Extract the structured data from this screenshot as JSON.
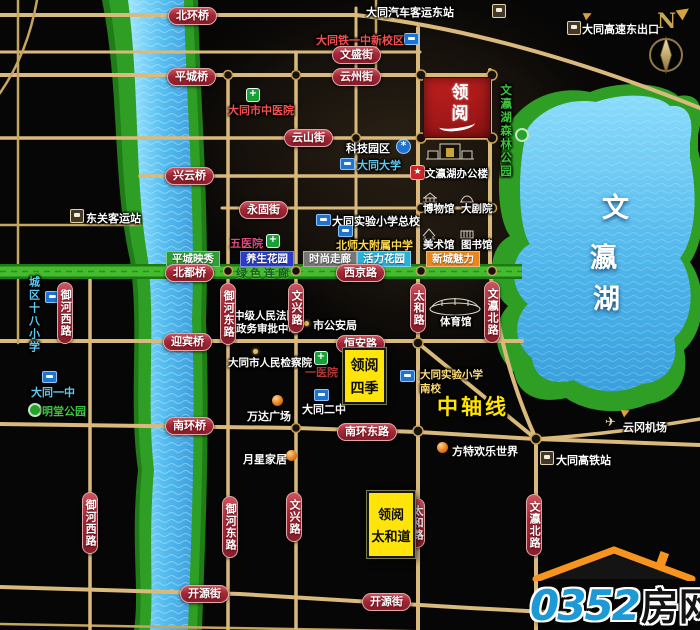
{
  "meta": {
    "compass": "N"
  },
  "project": {
    "logo_name": "领阅",
    "siji_line1": "领阅",
    "siji_line2": "四季",
    "taihedao_line1": "领阅",
    "taihedao_line2": "太和道"
  },
  "roads": {
    "beihuanqiao": "北环桥",
    "pingchengqiao": "平城桥",
    "wenshengjie": "文盛街",
    "yunzhoujie": "云州街",
    "yunshanjie": "云山街",
    "xingyunqiao": "兴云桥",
    "yonggujie": "永固街",
    "beiduqiao": "北都桥",
    "xijinglu": "西京路",
    "yingbinqiao": "迎宾桥",
    "henganlu": "恒安路",
    "nanhuanqiao": "南环桥",
    "nanhuandonglu": "南环东路",
    "kaiyuanjie": "开源街",
    "yuhexilu": "御河西路",
    "yuhedonglu": "御河东路",
    "wenxinglu": "文兴路",
    "taihelu": "太和路",
    "wenyingbeilu": "文瀛北路",
    "zhongzhouxian": "中轴线"
  },
  "zones": {
    "pingcheng_yingxiu": "平城映秀",
    "yangsheng_huayuan": "养生花园",
    "shishang_zoulan": "时尚走廊",
    "huoli_huayuan": "活力花园",
    "xincheng_meili": "新城魅力",
    "lvse_lianlang": "绿色连廊"
  },
  "places": {
    "qiche_keyun_dongzhan": "大同汽车客运东站",
    "gaosu_dongchukou": "大同高速东出口",
    "tieyizhong": "大同铁一中新校区",
    "zhongyiyuan": "大同市中医院",
    "keji_yuanqu": "科技园区",
    "datong_daxue": "大同大学",
    "senlin_gongyuan": "文瀛湖森林公园",
    "dongguan_keyunzhan": "东关客运站",
    "wuyiyuan": "五医院",
    "shiyan_zongxiao": "大同实验小学总校",
    "beishida": "北师大附属中学",
    "bangonglou": "文瀛湖办公楼",
    "bowuguan": "博物馆",
    "dajuyuan": "大剧院",
    "meishuguan": "美术馆",
    "tushuguan": "图书馆",
    "tiyuguan": "体育馆",
    "chengqu18": "城区十八小学",
    "fayuan": "中级人民法院",
    "shenpi": "政务审批中心",
    "gonganju": "市公安局",
    "jianchayuan": "大同市人民检察院",
    "yiyiyuan": "一医院",
    "shiyan_nanxiao_1": "大同实验小学",
    "shiyan_nanxiao_2": "南校",
    "datong_yizhong": "大同一中",
    "mingtang_gongyuan": "明堂公园",
    "datong_erzhong": "大同二中",
    "wanda": "万达广场",
    "fangte": "方特欢乐世界",
    "yuexing": "月星家居",
    "yungang_jichang": "云冈机场",
    "gaotiezhan": "大同高铁站",
    "lake_char_1": "文",
    "lake_char_2": "瀛",
    "lake_char_3": "湖"
  },
  "brand": {
    "number": "0352",
    "name": "房网",
    "url": "www.0352fang.com"
  },
  "colors": {
    "badge_red": "#a32737",
    "road_gold": "#d9b97c",
    "river_blue": "#5ec1ee",
    "park_green": "#2f9e35",
    "corridor_green": "#44bc2e",
    "highlight_yellow": "#ffe40a",
    "brand_blue": "#1d9ad6",
    "brand_orange": "#f7941d"
  }
}
